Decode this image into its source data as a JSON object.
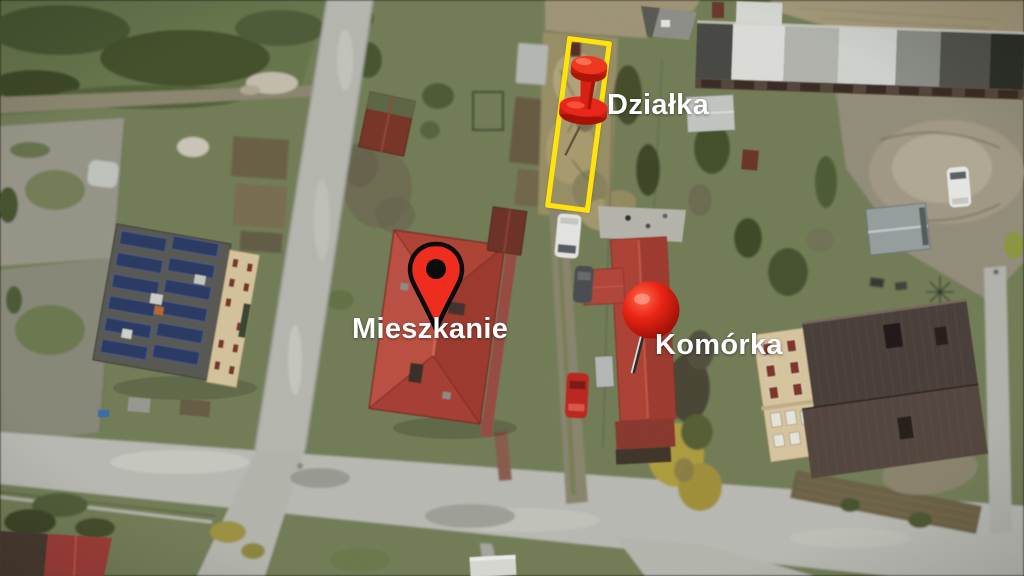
{
  "annotations": {
    "dzialka": {
      "label": "Działka",
      "marker": "pushpin-icon",
      "marker_color": "#e3261a",
      "outline_color": "#ffe30a"
    },
    "mieszkanie": {
      "label": "Mieszkanie",
      "marker": "map-pin-icon",
      "marker_color": "#ee2d1f"
    },
    "komorka": {
      "label": "Komórka",
      "marker": "ball-pin-icon",
      "marker_color": "#e6251b"
    }
  },
  "label_text_color": "#ffffff",
  "palette": {
    "grass": "#76815a",
    "road": "#bcbdb6",
    "dirt_path": "#8f8a73",
    "plot_scrub": "#9c9269",
    "red_roof": "#b3483d",
    "outbuilding_roof": "#b04438",
    "dark_roof": "#4e423c",
    "cream_wall": "#dbc9a3",
    "solar_panel_blue": "#32416b",
    "garage_roof_light": "#dedfdb",
    "highlight_yellow": "#ffe30a"
  }
}
